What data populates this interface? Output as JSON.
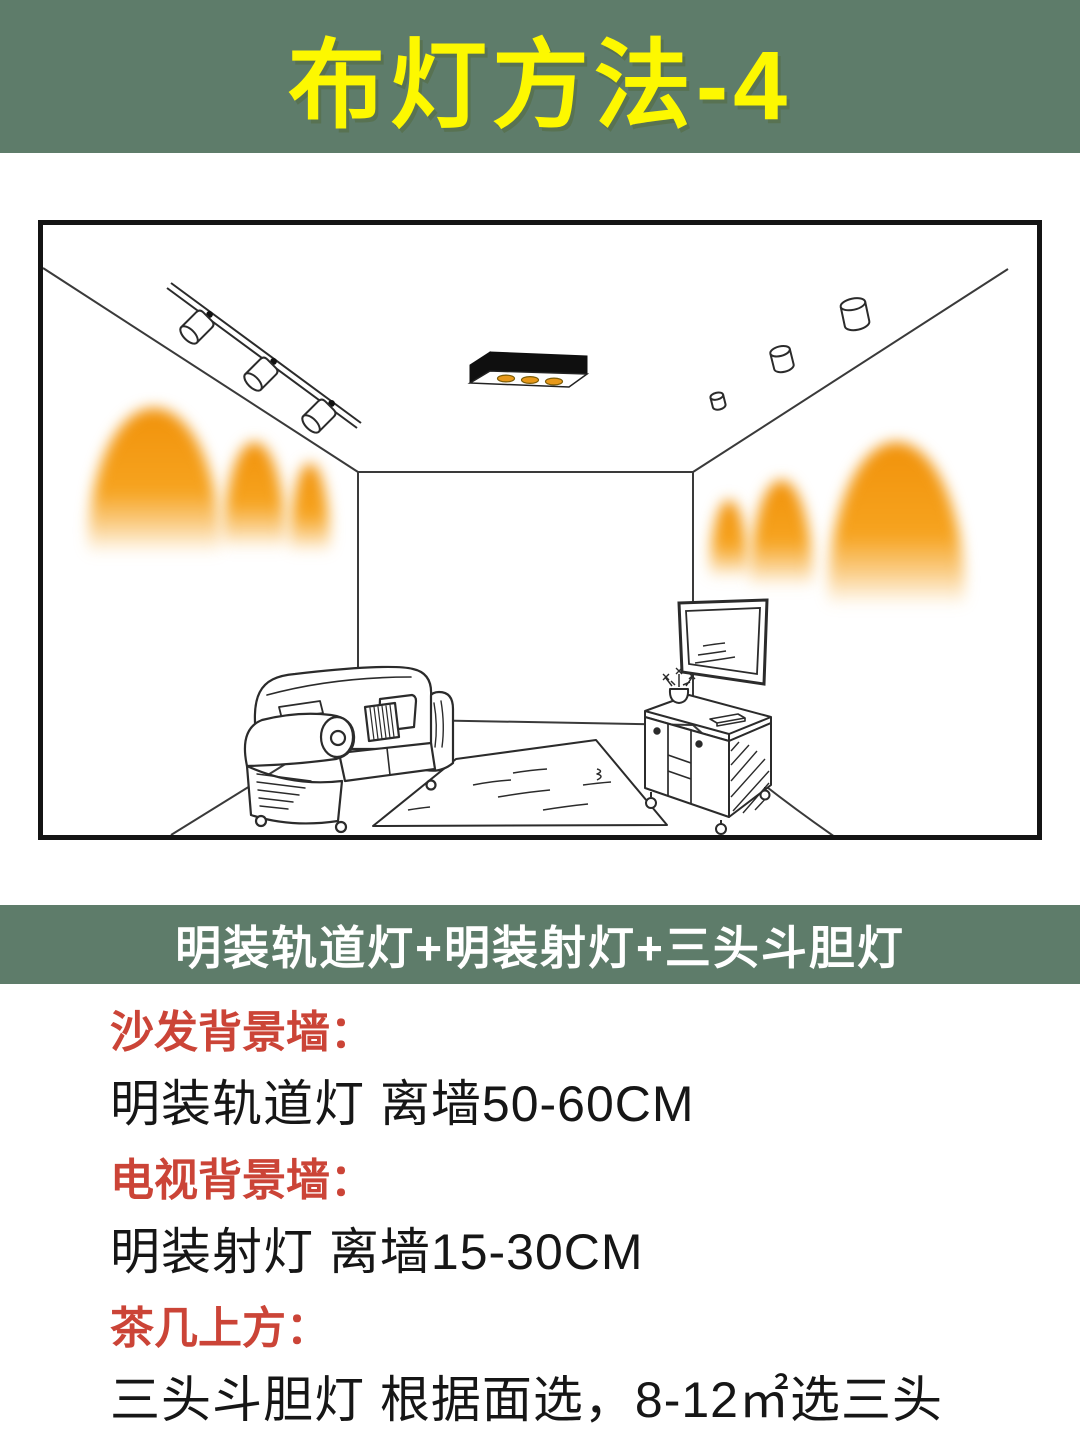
{
  "header": {
    "title": "布灯方法-4"
  },
  "method_banner": {
    "label": "明装轨道灯+明装射灯+三头斗胆灯"
  },
  "notes": [
    {
      "heading": "沙发背景墙：",
      "detail": "明装轨道灯 离墙50-60CM"
    },
    {
      "heading": "电视背景墙：",
      "detail": "明装射灯 离墙15-30CM"
    },
    {
      "heading": "茶几上方：",
      "detail": "三头斗胆灯 根据面选，8-12㎡选三头"
    }
  ],
  "illustration": {
    "description": "living room line drawing",
    "elements": [
      "track-light",
      "three-head-spotlight-fixture",
      "surface-mounted-spotlights",
      "wall-wash-light-glows",
      "sofa",
      "rug",
      "tv",
      "tv-cabinet",
      "plant"
    ]
  },
  "colors": {
    "banner_green": "#5e7c6a",
    "title_yellow": "#fdf800",
    "banner_text": "#ffffff",
    "heading_red": "#cb4437",
    "body_text": "#161616",
    "glow_orange": "#f6a31f",
    "lamp_amber": "#e8991a"
  }
}
